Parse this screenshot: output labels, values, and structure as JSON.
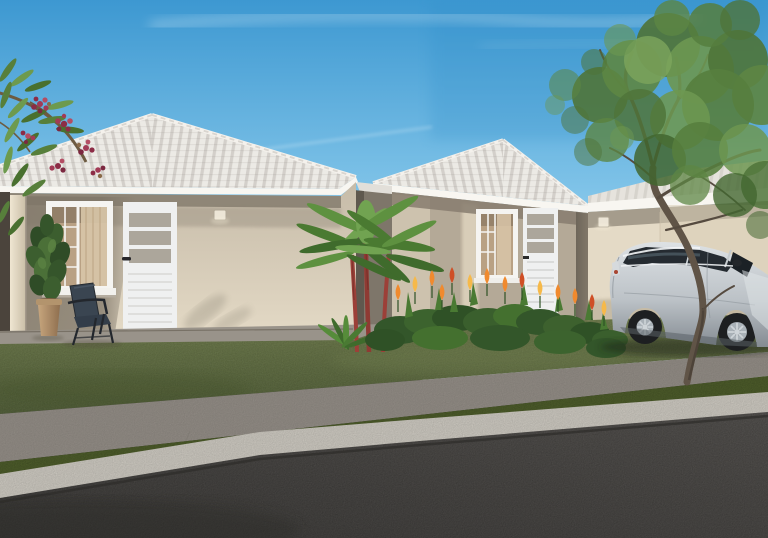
{
  "scene": {
    "type": "architectural-rendering",
    "description": "Two single-story beige houses with white hip tile roofs, front lawn, flower bed, palms, silver hatchback car, street tree, sidewalk, curb and asphalt road under a clear blue sky",
    "objects": [
      "sky",
      "clouds",
      "left-house",
      "right-house",
      "far-wall",
      "left-window",
      "left-door",
      "right-window",
      "right-door",
      "wall-sconce",
      "porch-column",
      "potted-plant",
      "patio-chair",
      "palm-cluster",
      "flower-bed",
      "flowering-branch",
      "lawn",
      "sidewalk",
      "grass-strip",
      "curb",
      "road",
      "car",
      "street-tree"
    ],
    "counts": {
      "houses": 2,
      "cars": 1,
      "doors": 2,
      "windows": 2,
      "wall_sconces": 2
    }
  },
  "palette": {
    "sky_top": "#3d98d1",
    "sky_mid": "#7fc3e8",
    "sky_horizon": "#d6edf7",
    "cloud": "#ffffff",
    "roof_tile": "#eceae5",
    "roof_fascia": "#f8f6f1",
    "wall_lit": "#e4dac6",
    "wall_mid": "#c6bba8",
    "wall_shadow": "#9c9285",
    "wall_dark": "#756c5f",
    "recess_dark": "#4b443c",
    "column": "#ecdfc9",
    "door": "#eff0f0",
    "door_pane": "#aca69b",
    "window_frame": "#f5f4f1",
    "curtain": "#d8c5a8",
    "glass_warm": "#b9a184",
    "sconce": "#ece5d6",
    "porch_concrete": "#99938a",
    "walk_concrete": "#97918a",
    "curb": "#d8d4cb",
    "road_light": "#565350",
    "road_dark": "#3b3937",
    "lawn_light": "#72814a",
    "lawn_dark": "#4c5b30",
    "hedge": "#3a5c2b",
    "hedge_light": "#558438",
    "flower_orange": "#f08a2e",
    "flower_amber": "#f6b94a",
    "flower_red": "#cf4f26",
    "palm_green": "#5f9140",
    "palm_dark": "#3f6b2c",
    "palm_stem": "#9c4038",
    "bloom_crimson": "#a23a55",
    "bloom_dark": "#7c2840",
    "leaf_green": "#62904a",
    "trunk": "#605447",
    "foliage": "#567e3e",
    "foliage_light": "#7da55c",
    "foliage_dark": "#42662f",
    "car_silver_light": "#dde1e4",
    "car_silver_dark": "#848b92",
    "car_glass": "#252b31",
    "tire": "#1d1f21",
    "rim": "#a9b1b7"
  }
}
